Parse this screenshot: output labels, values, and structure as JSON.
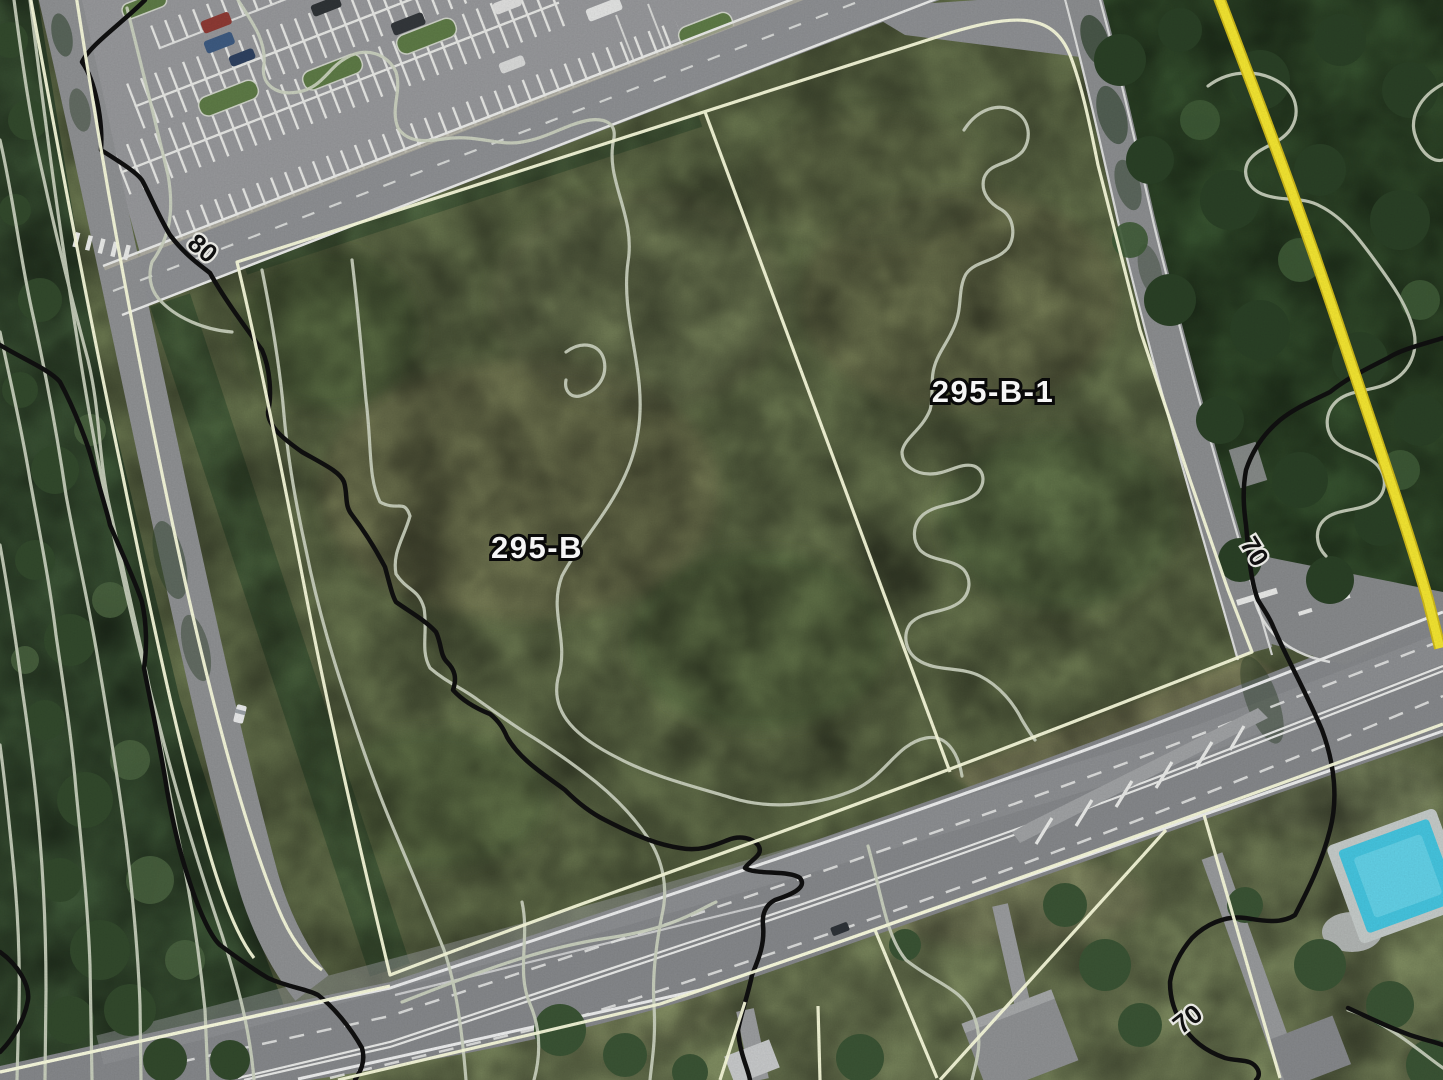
{
  "map": {
    "view": "aerial-parcel-map-with-contours",
    "parcel_labels": [
      {
        "id": "parcel-295-b",
        "text": "295-B"
      },
      {
        "id": "parcel-295-b-1",
        "text": "295-B-1"
      }
    ],
    "contour_labels": [
      {
        "id": "contour-80",
        "text": "80",
        "elevation": 80
      },
      {
        "id": "contour-70-upper",
        "text": "70",
        "elevation": 70
      },
      {
        "id": "contour-70-lower",
        "text": "70",
        "elevation": 70
      }
    ],
    "colors": {
      "parcel_line": "#f8fadc",
      "utility_line_yellow": "#f2e431",
      "utility_line_yellow_edge": "#cdb81a",
      "contour_light": "#ccd3c0",
      "contour_index_black": "#101010",
      "field_green": "#6b7850",
      "forest_green": "#3c5635",
      "road_gray": "#8b8d8f",
      "highway_gray": "#85878a",
      "parking_gray": "#96979a",
      "pool_blue": "#49c8e0",
      "parcel_label_fill": "#ffffff",
      "contour_label_fill": "#111111"
    }
  }
}
